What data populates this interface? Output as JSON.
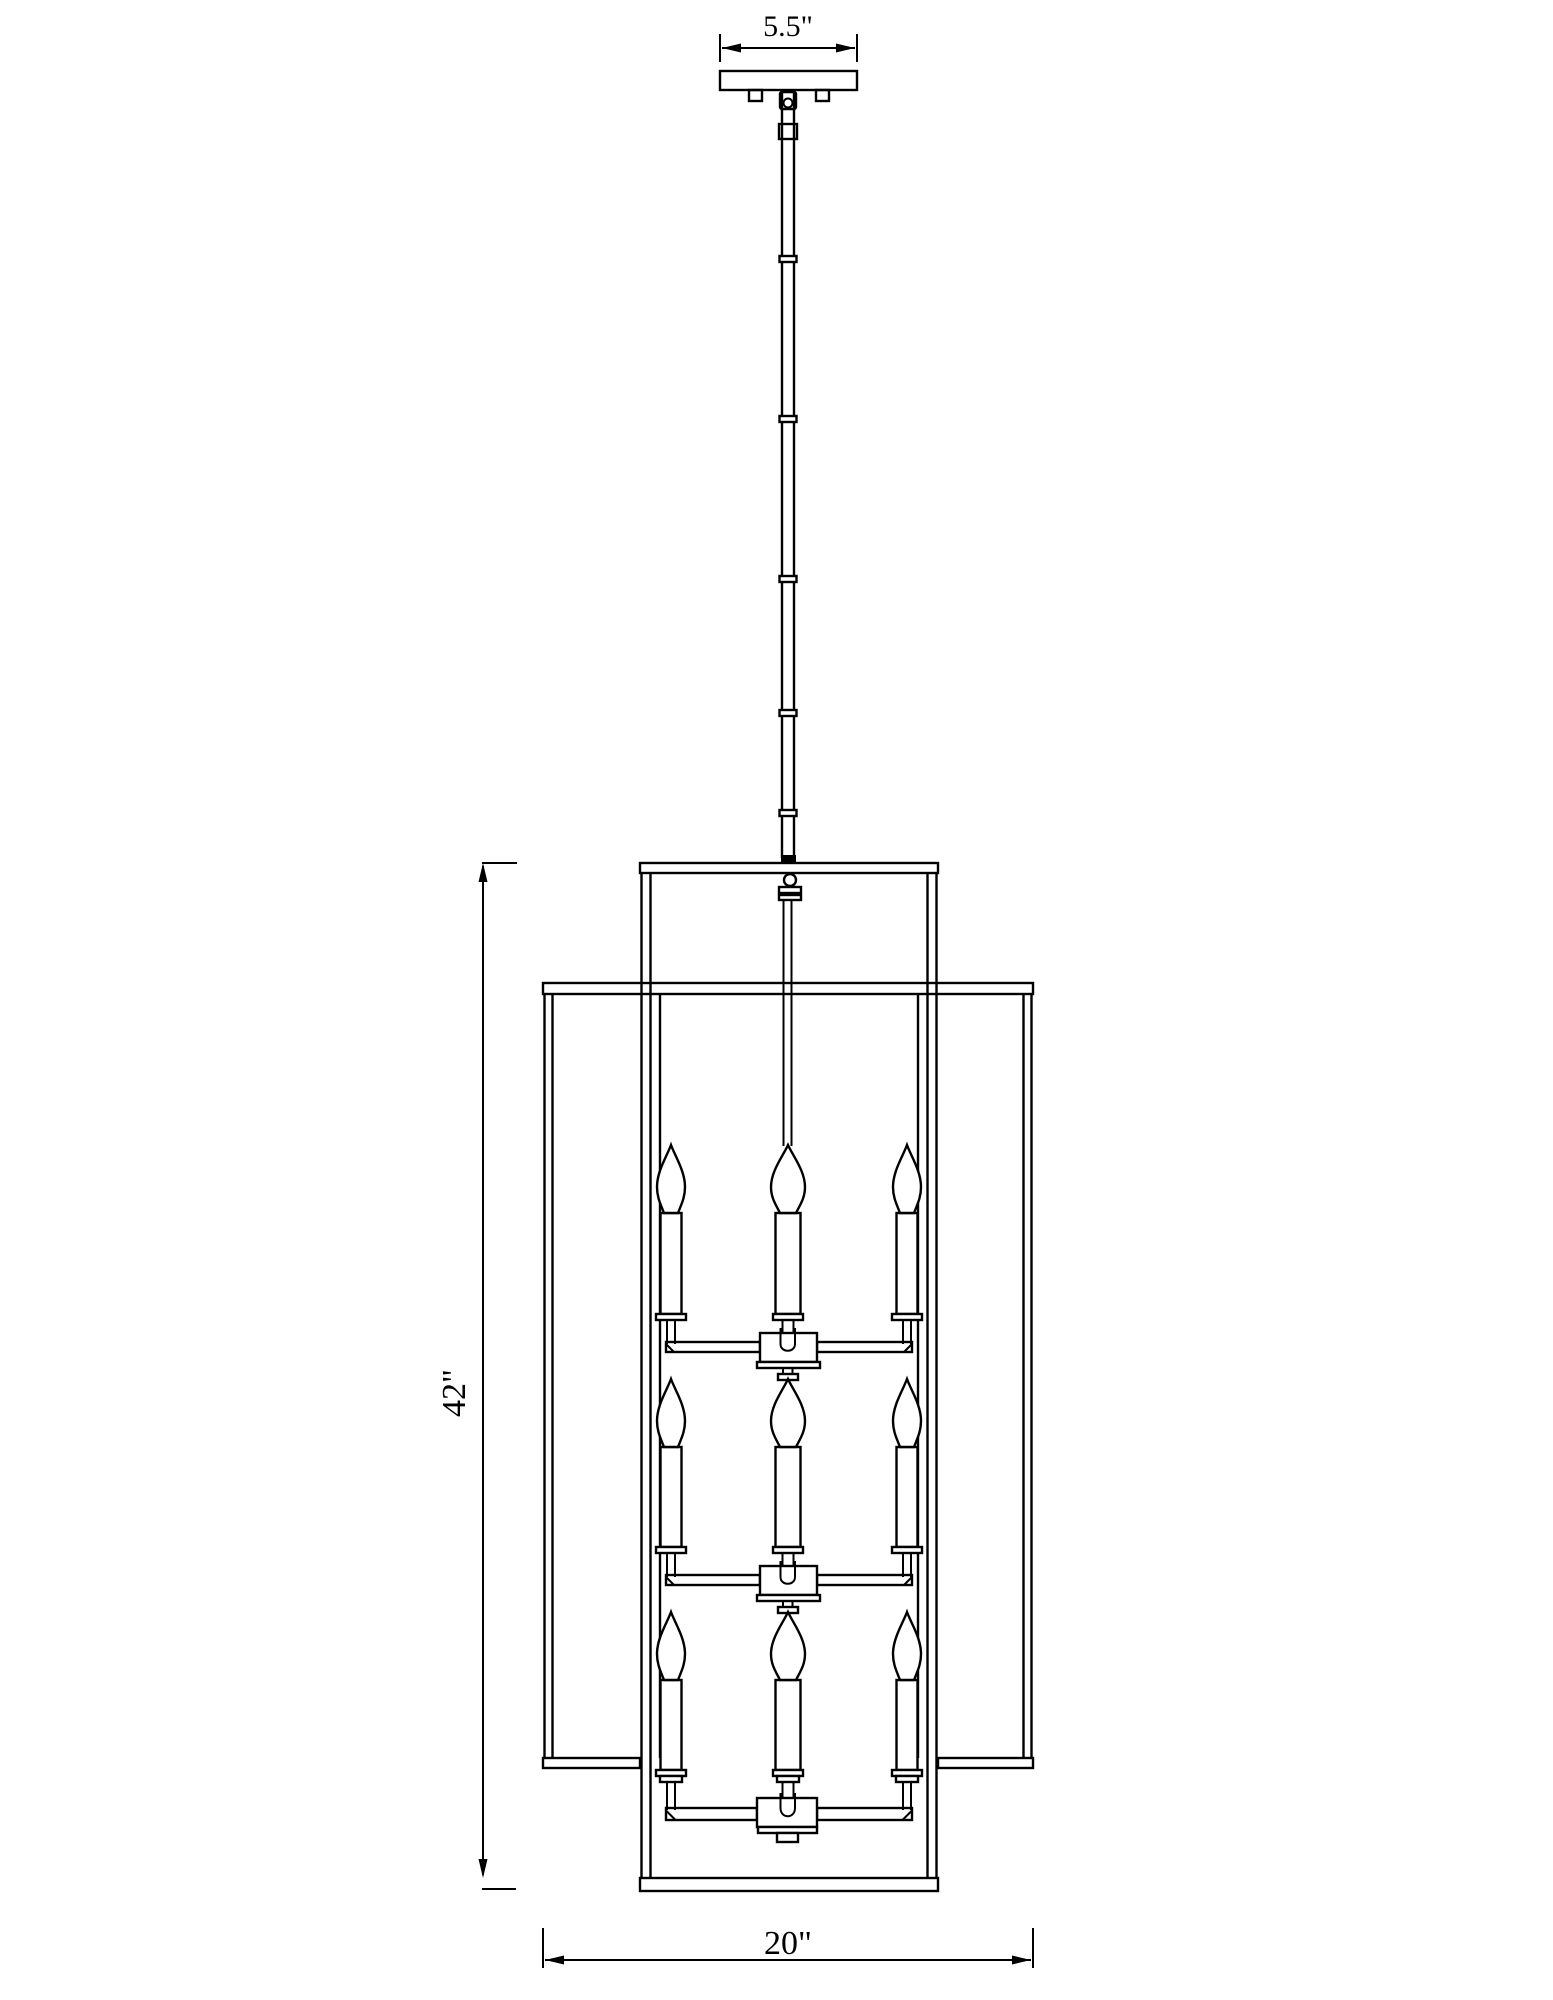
{
  "drawing": {
    "type": "pendant-light-dimension-diagram",
    "colors": {
      "background": "#ffffff",
      "line": "#000000"
    },
    "dimension_labels": {
      "canopy_width": "5.5\"",
      "fixture_height": "42\"",
      "fixture_width": "20\""
    }
  }
}
